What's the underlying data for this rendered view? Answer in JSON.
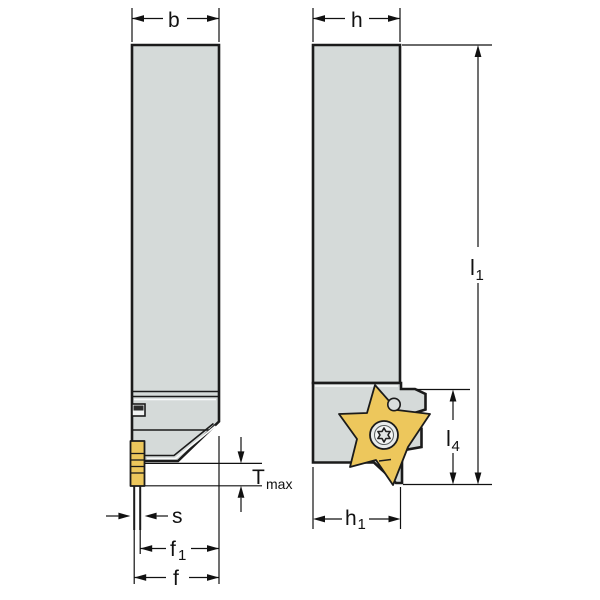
{
  "drawing": {
    "type": "tool-holder-dimension-drawing",
    "views": {
      "front": "front-view",
      "side": "side-view"
    }
  },
  "colors": {
    "body_gray": "#d5dad9",
    "insert_gold": "#edc75c",
    "outline": "#1b1b1b",
    "ink": "#111111",
    "highlight": "#fafbfb",
    "screw_ring": "#e8ebeb",
    "slot_dark": "#2c2c2c"
  },
  "dimensions": {
    "b": {
      "label": "b"
    },
    "h": {
      "label": "h"
    },
    "l1": {
      "label": "l",
      "sub": "1"
    },
    "l4": {
      "label": "l",
      "sub": "4"
    },
    "h1": {
      "label": "h",
      "sub": "1"
    },
    "s": {
      "label": "s"
    },
    "f1": {
      "label": "f",
      "sub": "1"
    },
    "f": {
      "label": "f"
    },
    "tmax": {
      "label": "T",
      "sub": "max"
    }
  }
}
